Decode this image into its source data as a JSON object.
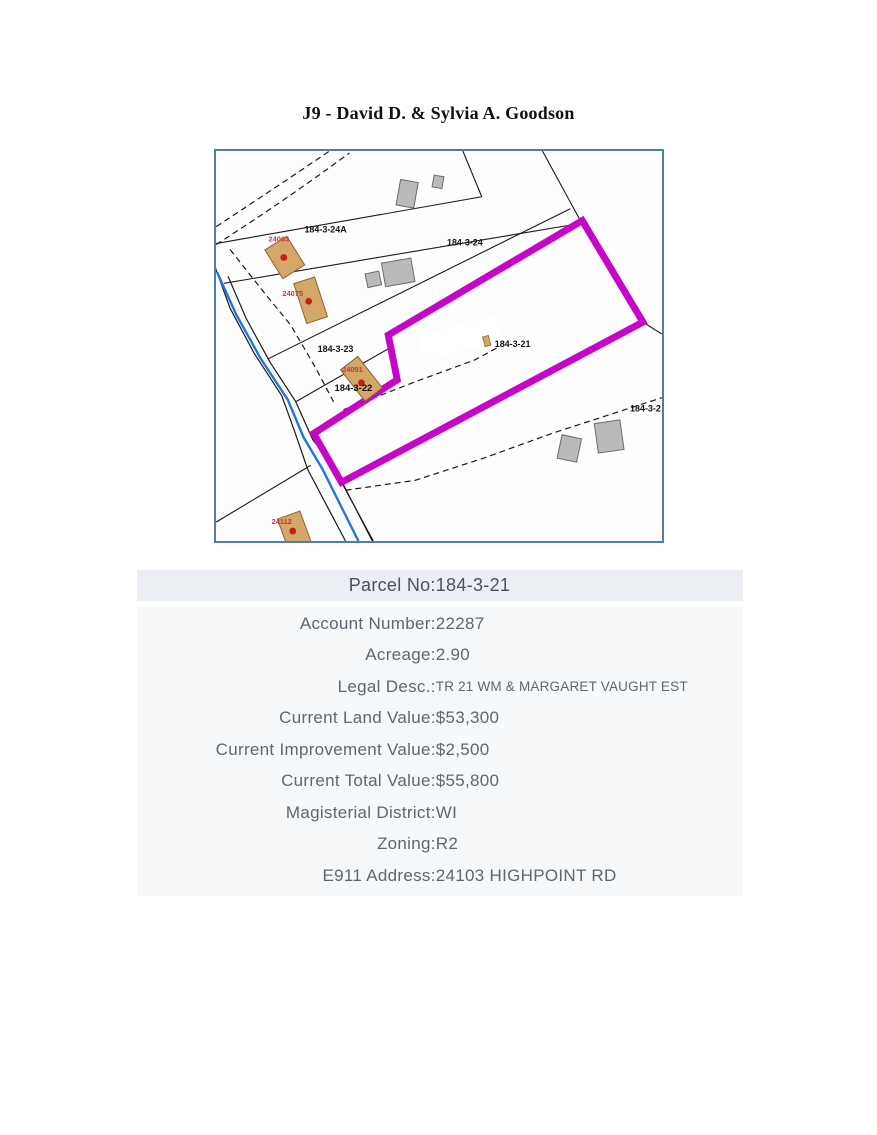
{
  "page": {
    "title": "J9 - David D. & Sylvia A. Goodson"
  },
  "map": {
    "parcel_labels": {
      "p24a": "184-3-24A",
      "p24": "184-3-24",
      "p23": "184-3-23",
      "p22": "184-3-22",
      "p21": "184-3-21",
      "p2": "184-3-2"
    },
    "address_labels": {
      "a24063": "24063",
      "a24075": "24075",
      "a24091": "24091",
      "a24112": "24112"
    },
    "colors": {
      "highlight_magenta": "#c606c6",
      "road_blue": "#1e78dc",
      "house_tan": "#d2a767",
      "building_gray": "#b9babc",
      "border_blue": "#4e7bb0",
      "marker_red": "#cc1d1d"
    }
  },
  "details": {
    "header": {
      "label": "Parcel No:",
      "value": "184-3-21"
    },
    "rows": [
      {
        "label": "Account Number:",
        "value": "22287"
      },
      {
        "label": "Acreage:",
        "value": "2.90"
      },
      {
        "label": "Legal Desc.:",
        "value": "TR 21 WM & MARGARET VAUGHT EST",
        "small": true
      },
      {
        "label": "Current Land Value:",
        "value": "$53,300"
      },
      {
        "label": "Current Improvement Value:",
        "value": "$2,500"
      },
      {
        "label": "Current Total Value:",
        "value": "$55,800"
      },
      {
        "label": "Magisterial District:",
        "value": "WI"
      },
      {
        "label": "Zoning:",
        "value": "R2"
      },
      {
        "label": "E911 Address:",
        "value": "24103 HIGHPOINT RD"
      }
    ]
  }
}
